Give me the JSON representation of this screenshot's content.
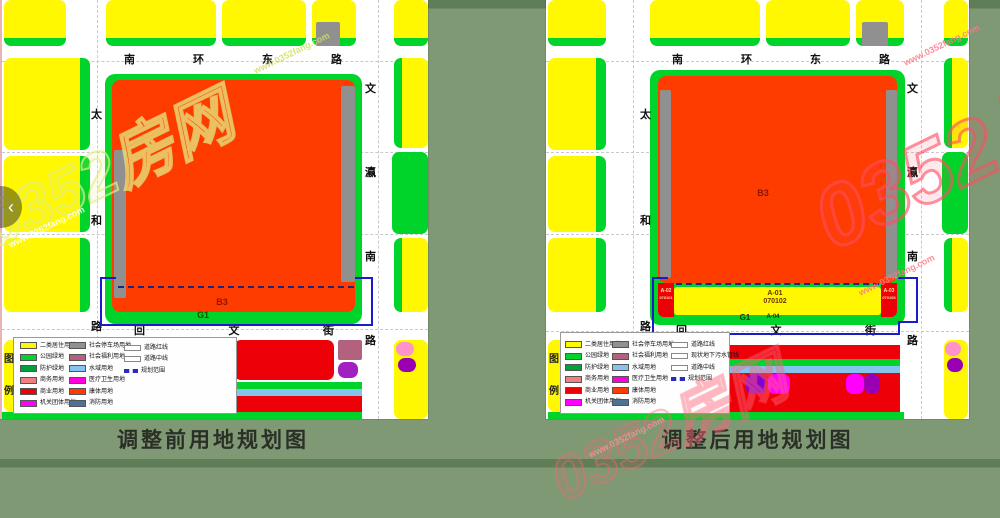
{
  "viewer": {
    "prev_arrow": "‹"
  },
  "watermark": {
    "brand": "0352房网",
    "url": "www.0352fang.com"
  },
  "colors": {
    "yellow": "#FFF800",
    "belt": "#00D42A",
    "park": "#00D42A",
    "protect": "#00A13C",
    "salmon": "#F08080",
    "red": "#EE0008",
    "magenta": "#FF00FF",
    "gray": "#909090",
    "mauve": "#B2617F",
    "water": "#85C4EE",
    "health": "#FF00DC",
    "sports": "#FF3C00",
    "fire": "#4E7296",
    "navy": "#1B1BC8",
    "gridline": "#c9c9c9"
  },
  "streets": {
    "north": "南环东路",
    "west": "太和路",
    "east": "文瀛南路",
    "south": "回文街"
  },
  "maps": {
    "before": {
      "title": "调整前用地规划图",
      "labels": {
        "b3": "B3",
        "g1": "G1"
      }
    },
    "after": {
      "title": "调整后用地规划图",
      "labels": {
        "b3": "B3",
        "g1": "G1",
        "a01": "A-01",
        "a01_code": "070102",
        "a02": "A-02",
        "a02_code": "070101",
        "a03": "A-03",
        "a03_code": "070103",
        "a04": "A-04"
      }
    }
  },
  "legend": {
    "title_chars": [
      "图",
      "例"
    ],
    "col1": [
      {
        "label": "二类居住用地",
        "color": "#FFF800"
      },
      {
        "label": "公园绿地",
        "color": "#00D42A"
      },
      {
        "label": "防护绿地",
        "color": "#00A13C"
      },
      {
        "label": "商务用地",
        "color": "#F08080"
      },
      {
        "label": "商业用地",
        "color": "#EE0008"
      },
      {
        "label": "机关团体用地",
        "color": "#FF00FF"
      }
    ],
    "col2": [
      {
        "label": "社会停车场用地",
        "color": "#909090"
      },
      {
        "label": "社会福利用地",
        "color": "#B2617F"
      },
      {
        "label": "水域用地",
        "color": "#85C4EE"
      },
      {
        "label": "医疗卫生用地",
        "color": "#FF00DC"
      },
      {
        "label": "康体用地",
        "color": "#FF3C00"
      },
      {
        "label": "消防用地",
        "color": "#4E7296"
      }
    ],
    "col3_before": [
      {
        "label": "道路红线",
        "type": "box"
      },
      {
        "label": "道路中线",
        "type": "box"
      },
      {
        "label": "规划范围",
        "type": "dashed"
      }
    ],
    "col3_after": [
      {
        "label": "道路红线",
        "type": "box"
      },
      {
        "label": "现状地下污水管线",
        "type": "box"
      },
      {
        "label": "道路中线",
        "type": "box"
      },
      {
        "label": "规划范围",
        "type": "dashed"
      }
    ]
  }
}
